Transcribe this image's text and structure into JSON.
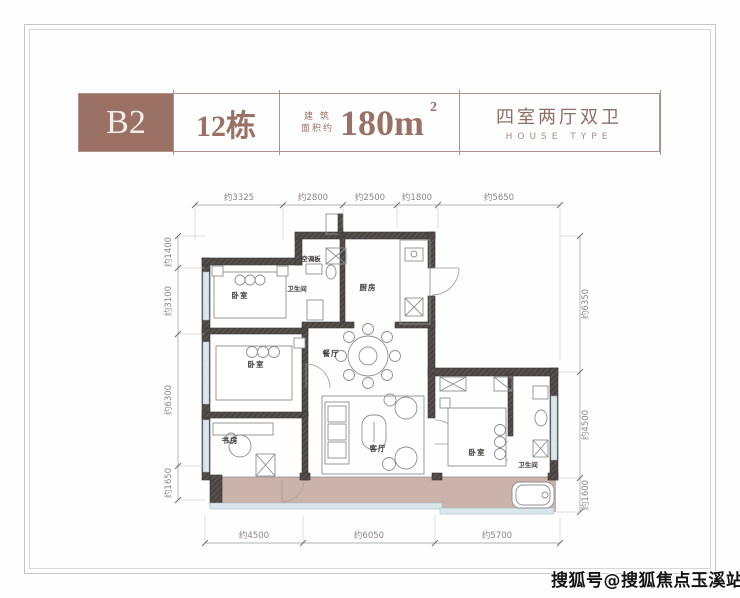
{
  "page": {
    "watermark": "搜狐号@搜狐焦点玉溪站"
  },
  "header": {
    "unit_code": "B2",
    "building": "12栋",
    "area_label_line1": "建 筑",
    "area_label_line2": "面积约",
    "area_value": "180m",
    "area_superscript": "2",
    "layout_cn": "四室两厅双卫",
    "layout_en": "HOUSE TYPE"
  },
  "floorplan": {
    "room_labels": {
      "bedroom_top": "卧室",
      "ac_panel": "空调板",
      "bathroom_1": "卫生间",
      "kitchen": "厨房",
      "dining": "餐厅",
      "bedroom_mid": "卧室",
      "study": "书房",
      "living": "客厅",
      "bedroom_master": "卧室",
      "bathroom_2": "卫生间"
    },
    "dimensions": {
      "top": [
        "约3325",
        "约2800",
        "约2500",
        "约1800",
        "约5650"
      ],
      "left": [
        "约1400",
        "约3100",
        "约6300",
        "约1650"
      ],
      "right": [
        "约6350",
        "约4500",
        "约1600"
      ],
      "bottom": [
        "约4500",
        "约6050",
        "约5700"
      ]
    }
  },
  "colors": {
    "accent_brown": "#9b7165",
    "balcony_fill": "#c7aba4",
    "wall_dark": "#3e3a39",
    "window_blue": "#d9e6ec"
  }
}
